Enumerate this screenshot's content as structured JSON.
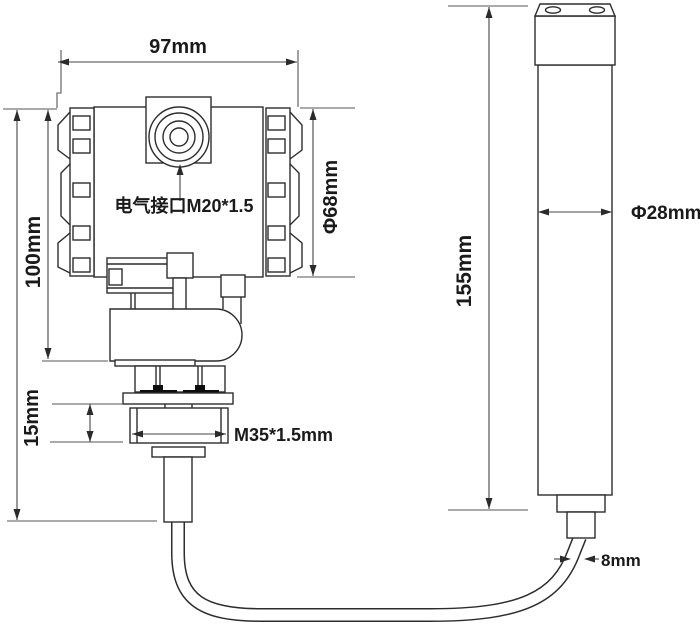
{
  "drawing": {
    "transmitter": {
      "top_width": "97mm",
      "body_height": "100mm",
      "body_diameter": "Φ68mm",
      "electrical_interface": "电气接口M20*1.5",
      "thread_section_height": "15mm",
      "thread_spec": "M35*1.5mm"
    },
    "probe": {
      "length": "155mm",
      "diameter": "Φ28mm",
      "cable_diameter": "8mm"
    },
    "colors": {
      "outline": "#2d2d2d",
      "dimension_line": "#454545",
      "text": "#1a1a1a",
      "seal": "#0d0d0d",
      "background": "#ffffff"
    }
  }
}
